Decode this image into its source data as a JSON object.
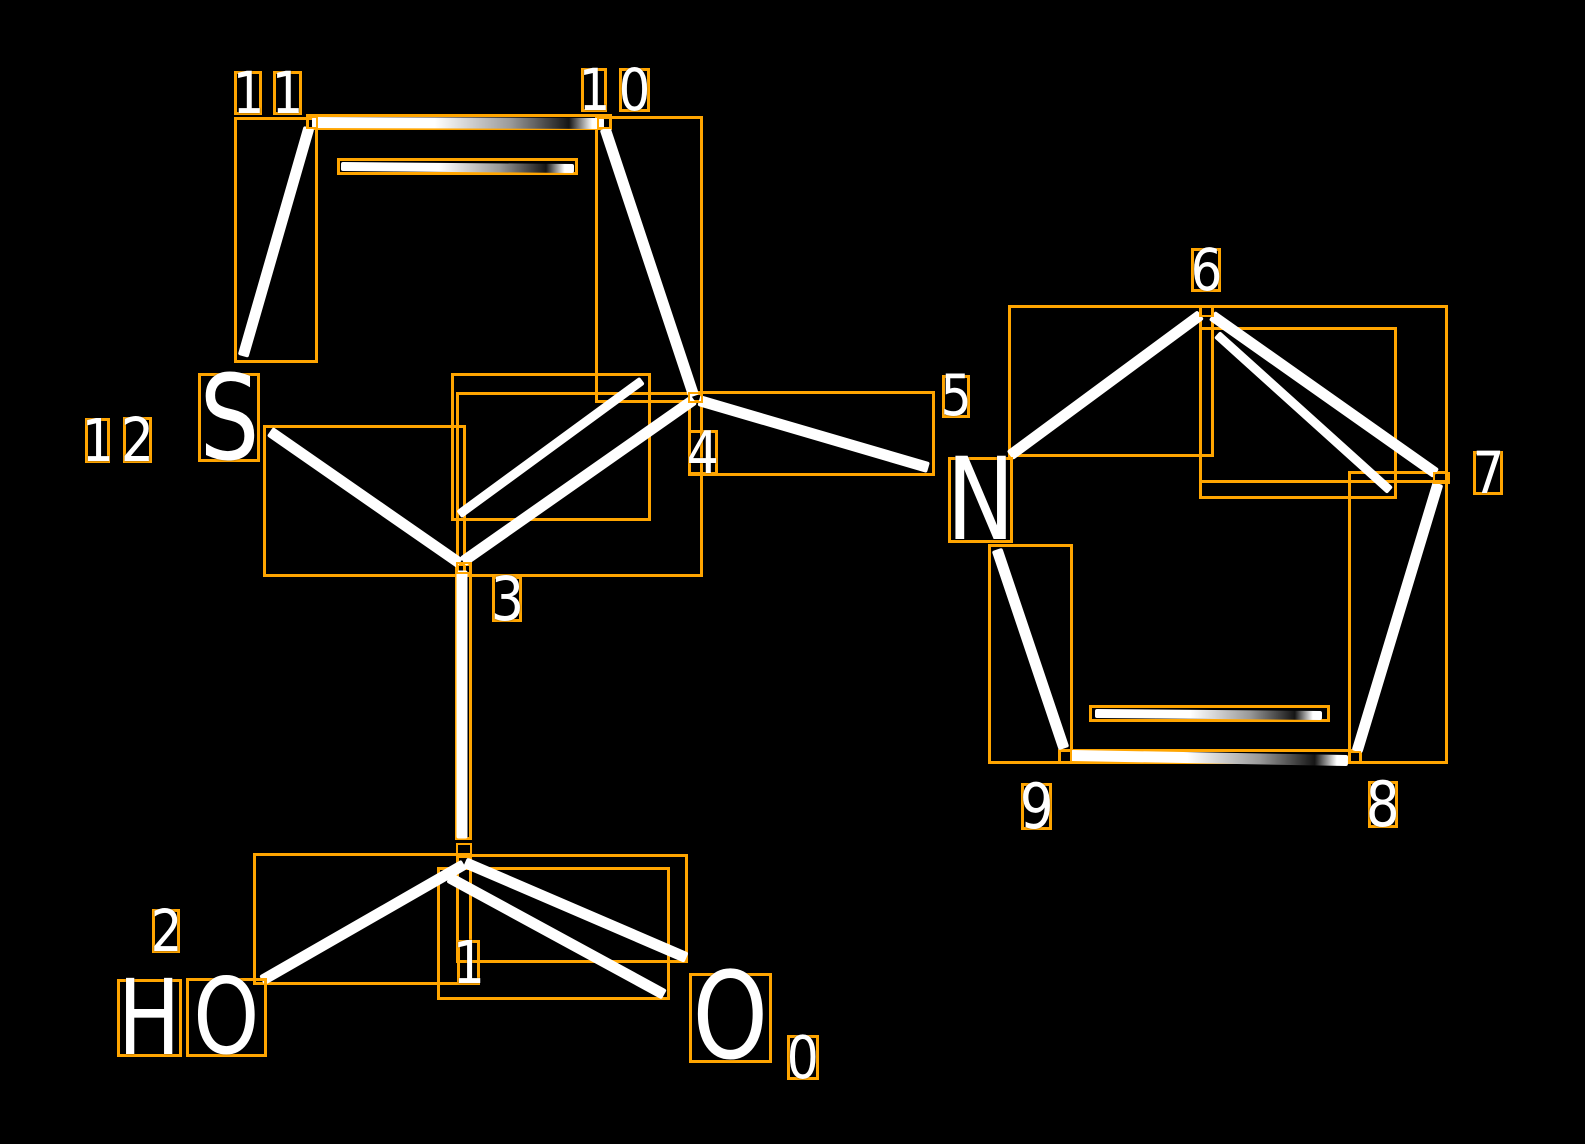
{
  "canvas": {
    "width": 1585,
    "height": 1144,
    "background": "#000000"
  },
  "colors": {
    "annotation_box": "#FFA500",
    "bond": "#FFFFFF",
    "label_text": "#FFFFFF"
  },
  "molecule": {
    "description": "Thiophene ring (S12,C11,C10,C4,C3) bearing a carboxylic acid (C1, O0 carbonyl, O2 hydroxyl) at C3 and a pyrrole ring (N5,C6,C7,C8,C9) at C4; every atom point and bond is outlined with an orange detection box and atoms are numbered 0-12.",
    "atoms": [
      {
        "index": 0,
        "symbol": "O"
      },
      {
        "index": 1,
        "symbol": "C"
      },
      {
        "index": 2,
        "symbol": "O",
        "drawn_as": "HO"
      },
      {
        "index": 3,
        "symbol": "C"
      },
      {
        "index": 4,
        "symbol": "C"
      },
      {
        "index": 5,
        "symbol": "N"
      },
      {
        "index": 6,
        "symbol": "C"
      },
      {
        "index": 7,
        "symbol": "C"
      },
      {
        "index": 8,
        "symbol": "C"
      },
      {
        "index": 9,
        "symbol": "C"
      },
      {
        "index": 10,
        "symbol": "C"
      },
      {
        "index": 11,
        "symbol": "C"
      },
      {
        "index": 12,
        "symbol": "S"
      }
    ],
    "bonds": [
      {
        "a": 1,
        "b": 0,
        "order": "double"
      },
      {
        "a": 1,
        "b": 2,
        "order": "single"
      },
      {
        "a": 3,
        "b": 1,
        "order": "single"
      },
      {
        "a": 3,
        "b": 4,
        "order": "double"
      },
      {
        "a": 12,
        "b": 3,
        "order": "single"
      },
      {
        "a": 11,
        "b": 12,
        "order": "single"
      },
      {
        "a": 11,
        "b": 10,
        "order": "double"
      },
      {
        "a": 10,
        "b": 4,
        "order": "single"
      },
      {
        "a": 4,
        "b": 5,
        "order": "single"
      },
      {
        "a": 5,
        "b": 6,
        "order": "single"
      },
      {
        "a": 6,
        "b": 7,
        "order": "double"
      },
      {
        "a": 7,
        "b": 8,
        "order": "single"
      },
      {
        "a": 8,
        "b": 9,
        "order": "double"
      },
      {
        "a": 9,
        "b": 5,
        "order": "single"
      }
    ]
  },
  "scene": {
    "bond_lines": [
      {
        "name": "bond-11-10",
        "pts": [
          312,
          122,
          604,
          123
        ],
        "w": 11,
        "fade": true
      },
      {
        "name": "bond-11-10-inner",
        "pts": [
          341,
          166,
          574,
          168
        ],
        "w": 9,
        "fade": true
      },
      {
        "name": "bond-11-12",
        "pts": [
          309,
          127,
          243,
          356
        ],
        "w": 11,
        "fade": false
      },
      {
        "name": "bond-12-3",
        "pts": [
          270,
          431,
          460,
          563
        ],
        "w": 11,
        "fade": false
      },
      {
        "name": "bond-3-4",
        "pts": [
          463,
          561,
          694,
          399
        ],
        "w": 11,
        "fade": false
      },
      {
        "name": "bond-3-4-inner",
        "pts": [
          459,
          514,
          642,
          380
        ],
        "w": 9,
        "fade": false
      },
      {
        "name": "bond-10-4",
        "pts": [
          605,
          128,
          694,
          396
        ],
        "w": 11,
        "fade": false
      },
      {
        "name": "bond-4-5",
        "pts": [
          699,
          400,
          928,
          467
        ],
        "w": 11,
        "fade": false
      },
      {
        "name": "bond-5-6",
        "pts": [
          1010,
          455,
          1201,
          314
        ],
        "w": 11,
        "fade": false
      },
      {
        "name": "bond-6-7",
        "pts": [
          1212,
          315,
          1436,
          473
        ],
        "w": 11,
        "fade": false
      },
      {
        "name": "bond-6-7-inner",
        "pts": [
          1217,
          334,
          1390,
          490
        ],
        "w": 9,
        "fade": false
      },
      {
        "name": "bond-7-8",
        "pts": [
          1438,
          483,
          1357,
          751
        ],
        "w": 11,
        "fade": false
      },
      {
        "name": "bond-8-9",
        "pts": [
          1071,
          755,
          1348,
          760
        ],
        "w": 11,
        "fade": true
      },
      {
        "name": "bond-8-9-inner",
        "pts": [
          1095,
          713,
          1322,
          715
        ],
        "w": 9,
        "fade": true
      },
      {
        "name": "bond-5-9",
        "pts": [
          997,
          549,
          1064,
          748
        ],
        "w": 11,
        "fade": false
      },
      {
        "name": "bond-3-1",
        "pts": [
          462,
          570,
          462,
          838
        ],
        "w": 11,
        "fade": false
      },
      {
        "name": "bond-1-2",
        "pts": [
          464,
          864,
          262,
          980
        ],
        "w": 11,
        "fade": false
      },
      {
        "name": "bond-1-0-a",
        "pts": [
          465,
          862,
          686,
          957
        ],
        "w": 11,
        "fade": false
      },
      {
        "name": "bond-1-0-b",
        "pts": [
          449,
          877,
          664,
          994
        ],
        "w": 11,
        "fade": false
      }
    ],
    "bond_boxes": [
      {
        "name": "bbox-bond-11-10",
        "box": [
          306,
          114,
          306,
          16
        ]
      },
      {
        "name": "bbox-bond-11-10-inner",
        "box": [
          337,
          158,
          241,
          17
        ]
      },
      {
        "name": "bbox-bond-11-12",
        "box": [
          234,
          117,
          84,
          246
        ]
      },
      {
        "name": "bbox-bond-12-3",
        "box": [
          263,
          425,
          203,
          152
        ]
      },
      {
        "name": "bbox-bond-3-4",
        "box": [
          456,
          392,
          247,
          185
        ]
      },
      {
        "name": "bbox-bond-3-4-inner",
        "box": [
          451,
          373,
          200,
          148
        ]
      },
      {
        "name": "bbox-bond-10-4",
        "box": [
          595,
          116,
          108,
          287
        ]
      },
      {
        "name": "bbox-bond-4-5",
        "box": [
          688,
          391,
          247,
          85
        ]
      },
      {
        "name": "bbox-bond-5-6",
        "box": [
          1008,
          305,
          206,
          152
        ]
      },
      {
        "name": "bbox-bond-6-7",
        "box": [
          1199,
          305,
          249,
          178
        ]
      },
      {
        "name": "bbox-bond-6-7-inner",
        "box": [
          1199,
          327,
          198,
          172
        ]
      },
      {
        "name": "bbox-bond-7-8",
        "box": [
          1348,
          471,
          100,
          293
        ]
      },
      {
        "name": "bbox-bond-8-9",
        "box": [
          1058,
          749,
          304,
          15
        ]
      },
      {
        "name": "bbox-bond-8-9-inner",
        "box": [
          1089,
          705,
          241,
          17
        ]
      },
      {
        "name": "bbox-bond-5-9",
        "box": [
          988,
          544,
          85,
          220
        ]
      },
      {
        "name": "bbox-bond-3-1",
        "box": [
          455,
          563,
          17,
          277
        ]
      },
      {
        "name": "bbox-bond-1-2",
        "box": [
          253,
          853,
          219,
          132
        ]
      },
      {
        "name": "bbox-bond-1-0-a",
        "box": [
          456,
          854,
          232,
          109
        ]
      },
      {
        "name": "bbox-bond-1-0-b",
        "box": [
          437,
          867,
          233,
          133
        ]
      }
    ],
    "point_boxes": [
      {
        "name": "pt-atom-11",
        "box": [
          306,
          116,
          12,
          13
        ]
      },
      {
        "name": "pt-atom-10",
        "box": [
          597,
          117,
          15,
          12
        ]
      },
      {
        "name": "pt-atom-6",
        "box": [
          1199,
          305,
          15,
          12
        ]
      },
      {
        "name": "pt-atom-7",
        "box": [
          1433,
          472,
          17,
          12
        ]
      },
      {
        "name": "pt-atom-9",
        "box": [
          1059,
          750,
          13,
          13
        ]
      },
      {
        "name": "pt-atom-8",
        "box": [
          1348,
          751,
          13,
          12
        ]
      },
      {
        "name": "pt-atom-4",
        "box": [
          688,
          392,
          15,
          11
        ]
      },
      {
        "name": "pt-atom-3",
        "box": [
          456,
          562,
          16,
          12
        ]
      },
      {
        "name": "pt-atom-1",
        "box": [
          456,
          843,
          16,
          15
        ]
      }
    ],
    "atom_letters": [
      {
        "text": "S",
        "box": [
          198,
          373,
          62,
          89
        ],
        "name": "atom-letter-S-12"
      },
      {
        "text": "N",
        "box": [
          948,
          457,
          65,
          86
        ],
        "name": "atom-letter-N-5"
      },
      {
        "text": "H",
        "box": [
          117,
          979,
          65,
          78
        ],
        "name": "atom-letter-H-hydroxyl"
      },
      {
        "text": "O",
        "box": [
          186,
          978,
          81,
          79
        ],
        "name": "atom-letter-O-hydroxyl-2"
      },
      {
        "text": "O",
        "box": [
          689,
          973,
          83,
          90
        ],
        "name": "atom-letter-O-carbonyl-0"
      }
    ],
    "index_labels": [
      {
        "text": "1",
        "box": [
          234,
          71,
          28,
          44
        ],
        "name": "label-11-digit-1"
      },
      {
        "text": "1",
        "box": [
          273,
          71,
          29,
          44
        ],
        "name": "label-11-digit-2"
      },
      {
        "text": "1",
        "box": [
          581,
          68,
          26,
          44
        ],
        "name": "label-10-digit-1"
      },
      {
        "text": "0",
        "box": [
          619,
          68,
          31,
          44
        ],
        "name": "label-10-digit-2"
      },
      {
        "text": "1",
        "box": [
          85,
          418,
          25,
          45
        ],
        "name": "label-12-digit-1"
      },
      {
        "text": "2",
        "box": [
          123,
          417,
          29,
          46
        ],
        "name": "label-12-digit-2"
      },
      {
        "text": "3",
        "box": [
          492,
          576,
          30,
          46
        ],
        "name": "label-3"
      },
      {
        "text": "4",
        "box": [
          688,
          430,
          30,
          45
        ],
        "name": "label-4"
      },
      {
        "text": "5",
        "box": [
          942,
          375,
          28,
          43
        ],
        "name": "label-5"
      },
      {
        "text": "6",
        "box": [
          1191,
          248,
          30,
          44
        ],
        "name": "label-6"
      },
      {
        "text": "7",
        "box": [
          1473,
          451,
          30,
          44
        ],
        "name": "label-7"
      },
      {
        "text": "8",
        "box": [
          1368,
          781,
          30,
          47
        ],
        "name": "label-8"
      },
      {
        "text": "9",
        "box": [
          1021,
          783,
          31,
          47
        ],
        "name": "label-9"
      },
      {
        "text": "2",
        "box": [
          152,
          909,
          28,
          44
        ],
        "name": "label-2"
      },
      {
        "text": "1",
        "box": [
          457,
          940,
          23,
          45
        ],
        "name": "label-1"
      },
      {
        "text": "0",
        "box": [
          787,
          1035,
          32,
          45
        ],
        "name": "label-0"
      }
    ]
  }
}
